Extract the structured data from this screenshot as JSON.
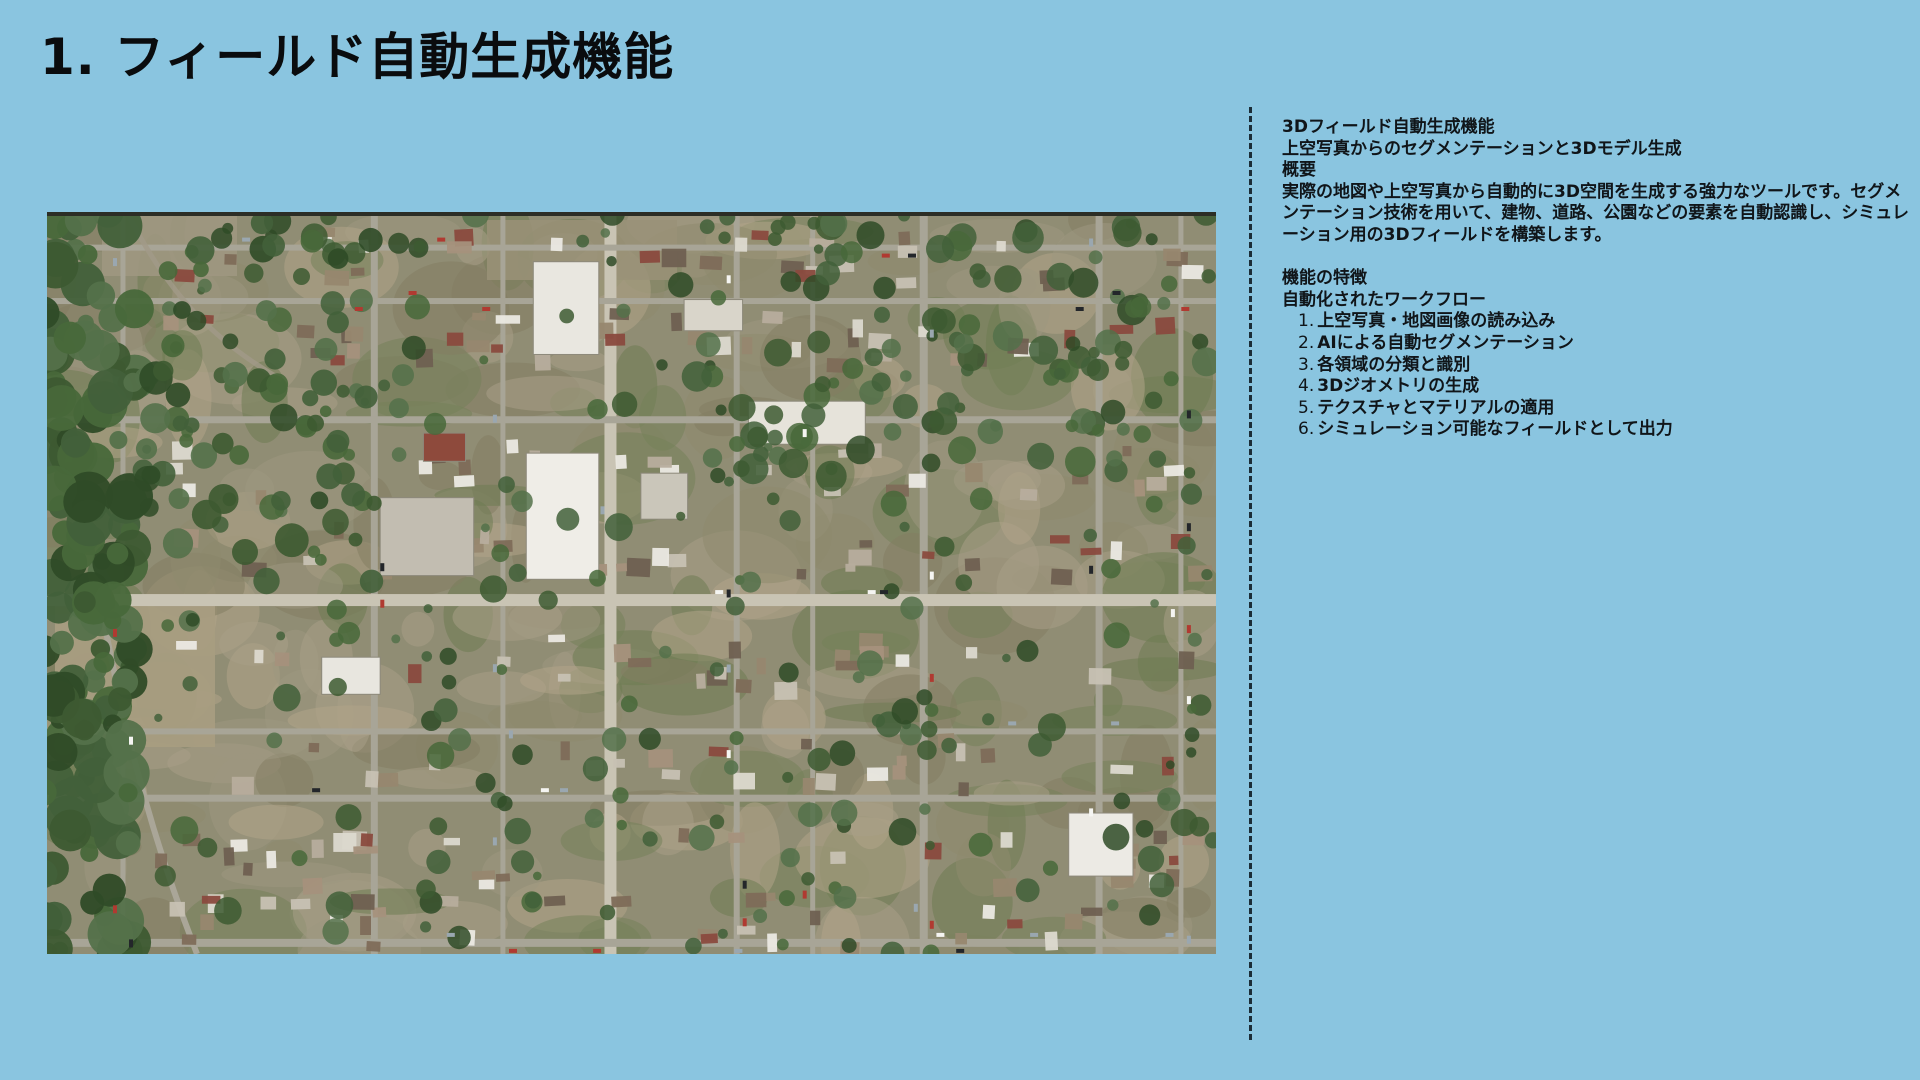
{
  "page": {
    "title": "1. フィールド自動生成機能",
    "background_color": "#8AC5E0",
    "divider_color": "#1b2d37",
    "text_color": "#101519"
  },
  "panel": {
    "feature_title": "3Dフィールド自動生成機能",
    "feature_subtitle": "上空写真からのセグメンテーションと3Dモデル生成",
    "overview_heading": "概要",
    "overview_body": "実際の地図や上空写真から自動的に3D空間を生成する強力なツールです。セグメンテーション技術を用いて、建物、道路、公園などの要素を自動認識し、シミュレーション用の3Dフィールドを構築します。",
    "features_heading": "機能の特徴",
    "workflow_heading": "自動化されたワークフロー",
    "workflow_steps": [
      {
        "num": "1.",
        "label": "上空写真・地図画像の読み込み"
      },
      {
        "num": "2.",
        "label": "AIによる自動セグメンテーション"
      },
      {
        "num": "3.",
        "label": "各領域の分類と識別"
      },
      {
        "num": "4.",
        "label": "3Dジオメトリの生成"
      },
      {
        "num": "5.",
        "label": "テクスチャとマテリアルの適用"
      },
      {
        "num": "6.",
        "label": "シミュレーション可能なフィールドとして出力"
      }
    ]
  }
}
